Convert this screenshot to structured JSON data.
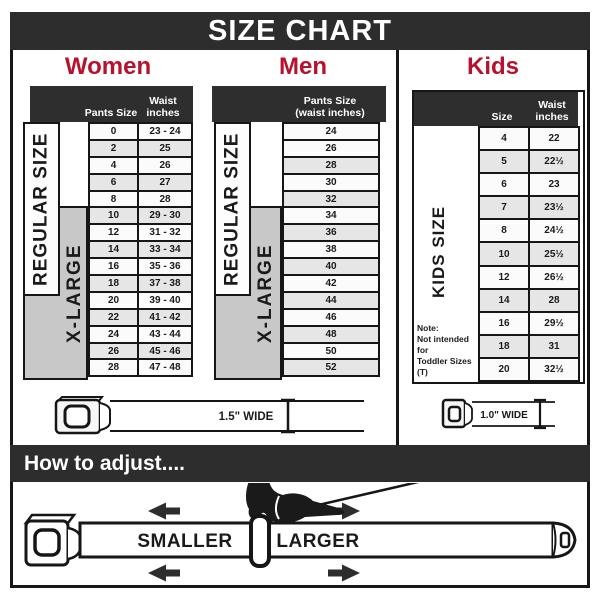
{
  "title": "SIZE CHART",
  "colors": {
    "accent_crimson": "#b8112e",
    "bar_dark": "#2d2d2d",
    "row_alt_gray": "#e6e6e6",
    "xlarge_box_gray": "#c8c8c8",
    "line_black": "#161616"
  },
  "chart_data": [
    {
      "type": "table",
      "group": "Women",
      "columns": [
        "Pants Size",
        "Waist inches"
      ],
      "group_labels": [
        "REGULAR SIZE",
        "X-LARGE"
      ],
      "rows": [
        [
          "0",
          "23 - 24"
        ],
        [
          "2",
          "25"
        ],
        [
          "4",
          "26"
        ],
        [
          "6",
          "27"
        ],
        [
          "8",
          "28"
        ],
        [
          "10",
          "29 - 30"
        ],
        [
          "12",
          "31 - 32"
        ],
        [
          "14",
          "33 - 34"
        ],
        [
          "16",
          "35 - 36"
        ],
        [
          "18",
          "37 - 38"
        ],
        [
          "20",
          "39 - 40"
        ],
        [
          "22",
          "41 - 42"
        ],
        [
          "24",
          "43 - 44"
        ],
        [
          "26",
          "45 - 46"
        ],
        [
          "28",
          "47 - 48"
        ]
      ]
    },
    {
      "type": "table",
      "group": "Men",
      "columns": [
        "Pants Size (waist inches)"
      ],
      "header_lines": [
        "Pants Size",
        "(waist inches)"
      ],
      "group_labels": [
        "REGULAR SIZE",
        "X-LARGE"
      ],
      "rows": [
        [
          "24"
        ],
        [
          "26"
        ],
        [
          "28"
        ],
        [
          "30"
        ],
        [
          "32"
        ],
        [
          "34"
        ],
        [
          "36"
        ],
        [
          "38"
        ],
        [
          "40"
        ],
        [
          "42"
        ],
        [
          "44"
        ],
        [
          "46"
        ],
        [
          "48"
        ],
        [
          "50"
        ],
        [
          "52"
        ]
      ]
    },
    {
      "type": "table",
      "group": "Kids",
      "columns": [
        "Size",
        "Waist inches"
      ],
      "group_labels": [
        "KIDS SIZE"
      ],
      "note_lines": [
        "Note:",
        "Not intended for",
        "Toddler Sizes (T)"
      ],
      "rows": [
        [
          "4",
          "22"
        ],
        [
          "5",
          "22½"
        ],
        [
          "6",
          "23"
        ],
        [
          "7",
          "23½"
        ],
        [
          "8",
          "24½"
        ],
        [
          "10",
          "25½"
        ],
        [
          "12",
          "26½"
        ],
        [
          "14",
          "28"
        ],
        [
          "16",
          "29½"
        ],
        [
          "18",
          "31"
        ],
        [
          "20",
          "32½"
        ]
      ]
    }
  ],
  "belts": {
    "adult_width_label": "1.5\" WIDE",
    "kids_width_label": "1.0\" WIDE"
  },
  "adjust": {
    "bar_title": "How to adjust....",
    "smaller_label": "SMALLER",
    "larger_label": "LARGER"
  }
}
